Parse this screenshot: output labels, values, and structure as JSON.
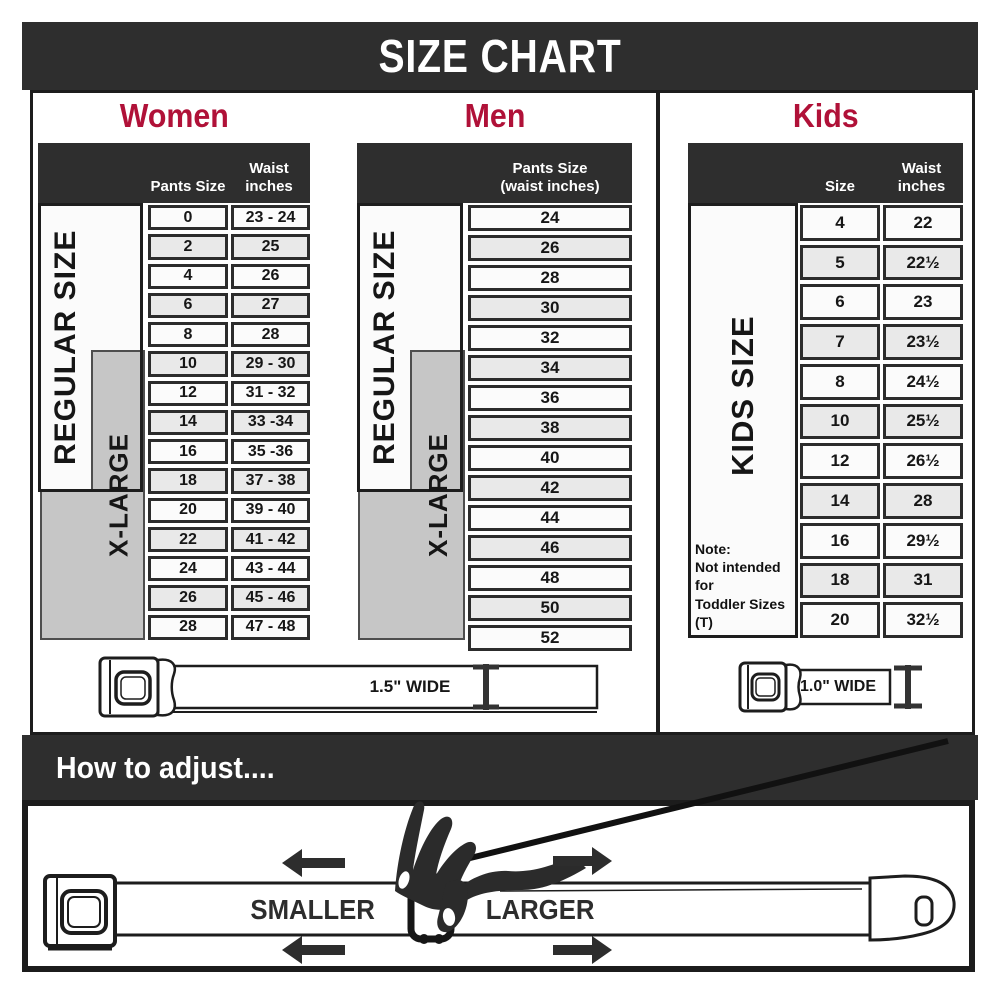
{
  "title": "SIZE CHART",
  "women": {
    "heading": "Women",
    "col1": "Pants Size",
    "col2_line1": "Waist",
    "col2_line2": "inches",
    "regular_label": "REGULAR SIZE",
    "xlarge_label": "X-LARGE",
    "rows": [
      [
        "0",
        "23 - 24"
      ],
      [
        "2",
        "25"
      ],
      [
        "4",
        "26"
      ],
      [
        "6",
        "27"
      ],
      [
        "8",
        "28"
      ],
      [
        "10",
        "29 - 30"
      ],
      [
        "12",
        "31 - 32"
      ],
      [
        "14",
        "33 -34"
      ],
      [
        "16",
        "35 -36"
      ],
      [
        "18",
        "37 - 38"
      ],
      [
        "20",
        "39 - 40"
      ],
      [
        "22",
        "41 - 42"
      ],
      [
        "24",
        "43 - 44"
      ],
      [
        "26",
        "45 - 46"
      ],
      [
        "28",
        "47 - 48"
      ]
    ]
  },
  "men": {
    "heading": "Men",
    "col_line1": "Pants Size",
    "col_line2": "(waist inches)",
    "regular_label": "REGULAR SIZE",
    "xlarge_label": "X-LARGE",
    "rows": [
      "24",
      "26",
      "28",
      "30",
      "32",
      "34",
      "36",
      "38",
      "40",
      "42",
      "44",
      "46",
      "48",
      "50",
      "52"
    ]
  },
  "kids": {
    "heading": "Kids",
    "col1": "Size",
    "col2_line1": "Waist",
    "col2_line2": "inches",
    "label": "KIDS SIZE",
    "note_line1": "Note:",
    "note_line2": "Not intended for",
    "note_line3": "Toddler Sizes (T)",
    "rows": [
      [
        "4",
        "22"
      ],
      [
        "5",
        "22½"
      ],
      [
        "6",
        "23"
      ],
      [
        "7",
        "23½"
      ],
      [
        "8",
        "24½"
      ],
      [
        "10",
        "25½"
      ],
      [
        "12",
        "26½"
      ],
      [
        "14",
        "28"
      ],
      [
        "16",
        "29½"
      ],
      [
        "18",
        "31"
      ],
      [
        "20",
        "32½"
      ]
    ]
  },
  "belts": {
    "adult_width_label": "1.5\" WIDE",
    "kids_width_label": "1.0\" WIDE"
  },
  "adjust": {
    "heading": "How to adjust....",
    "smaller": "SMALLER",
    "larger": "LARGER"
  },
  "colors": {
    "dark_band": "#2e2e2e",
    "heading_red": "#b01138",
    "row_alt": "#e9e9e9",
    "xlarge_gray": "#c6c6c6"
  }
}
